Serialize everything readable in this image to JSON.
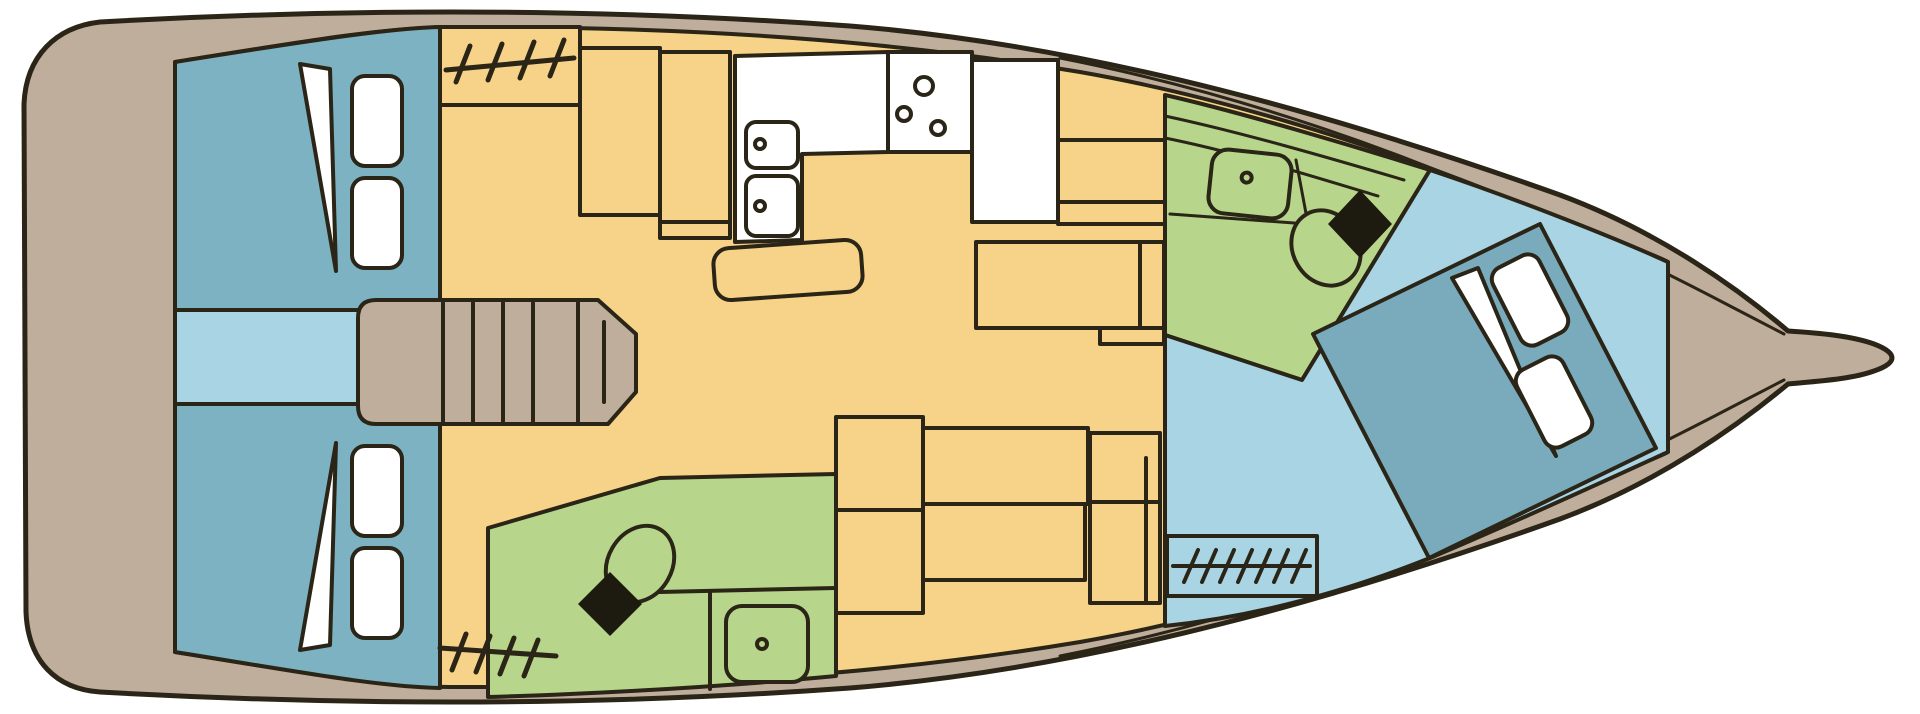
{
  "diagram": {
    "type": "yacht-deck-plan",
    "description": "Top-down interior layout plan of a sailing yacht, bow pointing right, stern at left",
    "orientation": {
      "bow": "right",
      "stern": "left",
      "top_side": "port",
      "bottom_side": "starboard"
    },
    "summary": {
      "cabins": 3,
      "heads": 2,
      "double_berths": 3
    }
  },
  "palette": {
    "background": "#ffffff",
    "outline": "#2a2517",
    "hull": "#bfae9c",
    "interior": "#f6d388",
    "cabin": "#7db2c3",
    "passage": "#a8d4e3",
    "bed": "#7aabbd",
    "bathroom": "#b7d68b",
    "fixture": "#ffffff",
    "toilet_lid": "#1d1a10"
  },
  "rooms": [
    {
      "id": "aft-cabin-port",
      "name": "aft double cabin (port)"
    },
    {
      "id": "aft-cabin-starboard",
      "name": "aft double cabin (starboard)"
    },
    {
      "id": "passageway",
      "name": "companionway passage"
    },
    {
      "id": "saloon",
      "name": "saloon and galley"
    },
    {
      "id": "head-port-forward",
      "name": "head / bathroom (port forward)"
    },
    {
      "id": "head-starboard",
      "name": "head / bathroom (starboard)"
    },
    {
      "id": "forward-cabin",
      "name": "forward owner cabin"
    }
  ],
  "fixtures": [
    "double-berth",
    "pillow",
    "blanket-fold",
    "companionway-steps",
    "galley-double-sink",
    "stove-3-burner",
    "refrigerator-counter",
    "saloon-table",
    "dinette-seating",
    "nav-station",
    "washbasin",
    "marine-toilet",
    "hanging-locker-hatch",
    "bowsprit"
  ]
}
